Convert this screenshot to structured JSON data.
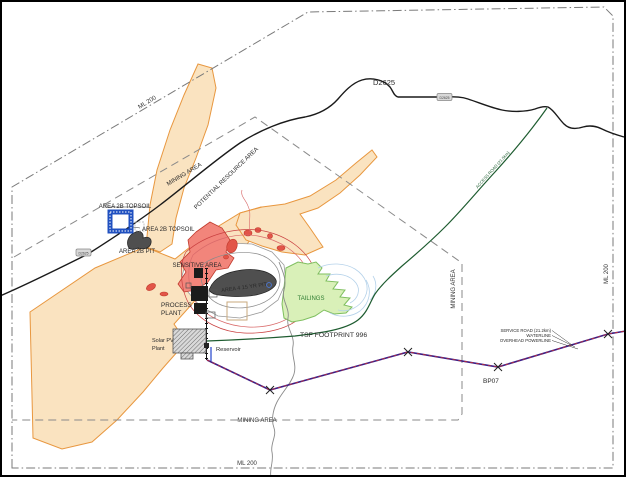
{
  "map_type": "mine-site-layout-plan",
  "colors": {
    "resource_area_fill": "#FAE3C0",
    "resource_area_stroke": "#E8973F",
    "sensitive_area_fill": "#F2857B",
    "sensitive_area_stroke": "#C03A2C",
    "pit_fill": "#4F4F4F",
    "tailings_fill": "#D9F0B8",
    "tailings_stroke": "#7FBF5F",
    "tailings_text": "#2F7D32",
    "access_road_green": "#1E5C30",
    "road_black": "#1A1A1A",
    "boundary_gray": "#7A7A7A",
    "service_line_purple": "#3B1D86",
    "service_line_red_dash": "#D03030",
    "topsoil_blue": "#2050C0",
    "water_blue": "#B5D2EA"
  },
  "labels": {
    "ml200": "ML 200",
    "mining_area": "MINING AREA",
    "potential_resource_area": "POTENTIAL RESOURCE AREA",
    "area_2b_topsoil": "AREA 2B TOPSOIL",
    "area_2b_pit": "AREA 2B PIT",
    "sensitive_area": "SENSITIVE AREA",
    "area_4_pit": "AREA 4 15 YR PIT",
    "process_plant_line1": "PROCESS",
    "process_plant_line2": "PLANT",
    "solar_line1": "Solar PV",
    "solar_line2": "Plant",
    "reservoir": "Reservoir",
    "tailings": "TAILINGS",
    "tsf_footprint": "TSF FOOTPRINT 996",
    "road_d2625": "D2625",
    "road_badge": "D2625",
    "access_road": "ACCESS ROAD (21.5km)",
    "service_road": "SERVICE ROAD (21.2km)",
    "waterline": "WATERLINE",
    "overhead_powerline": "OVERHEAD POWERLINE",
    "bp07": "BP07"
  }
}
